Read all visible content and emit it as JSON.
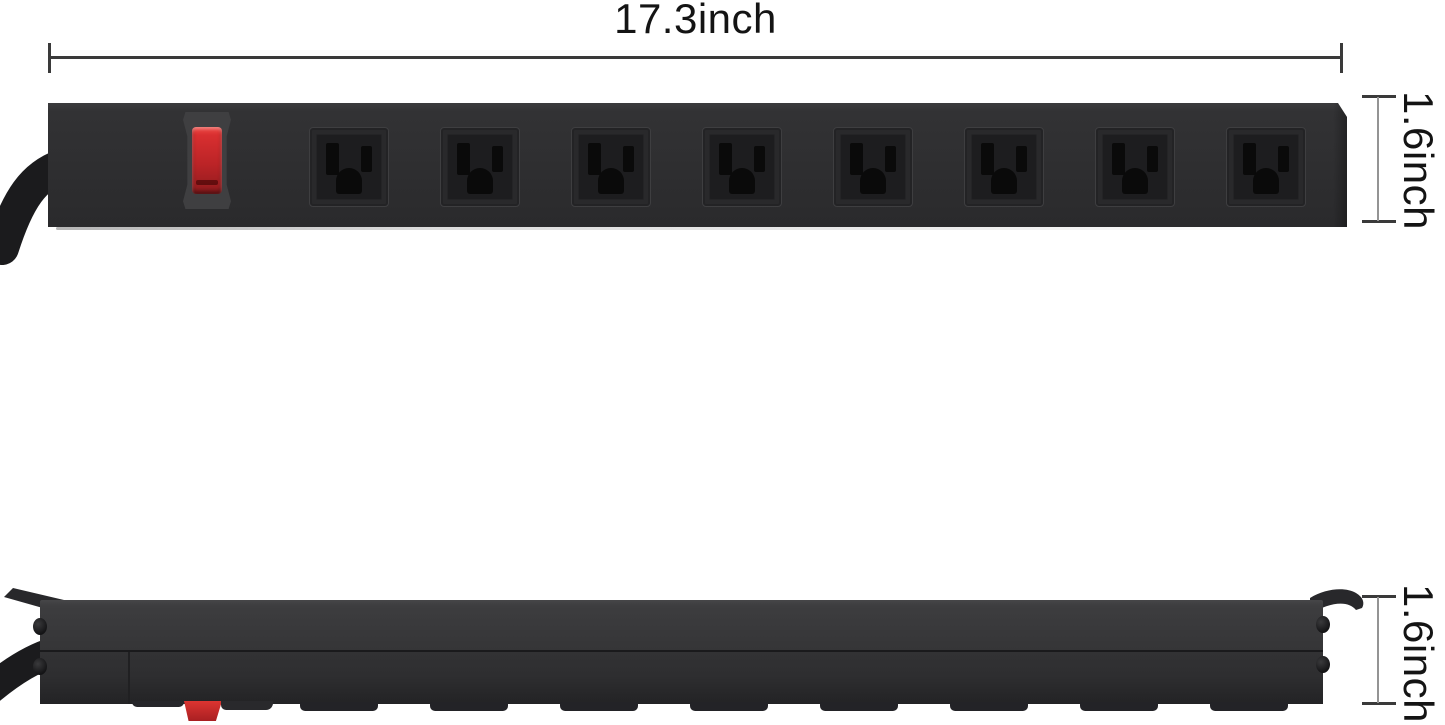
{
  "background": "#ffffff",
  "annotations": {
    "width": "17.3inch",
    "height_front": "1.6inch",
    "height_side": "1.6inch"
  },
  "colors": {
    "strip_body": "#2e2e30",
    "side_top": "#353537",
    "outlet_face": "#29292b",
    "outlet_recess": "#1d1d1f",
    "slot": "#0a0a0a",
    "bezel": "#3f3f41",
    "switch_red": "#bc2427",
    "cord": "#1b1b1d",
    "dim_line": "#949494",
    "dim_dark": "#3a3a3a",
    "dim_text": "#141414"
  },
  "front_view": {
    "description": "black metal power strip, front face",
    "switch": "red-power-switch",
    "outlets": [
      {
        "name": "outlet-1"
      },
      {
        "name": "outlet-2"
      },
      {
        "name": "outlet-3"
      },
      {
        "name": "outlet-4"
      },
      {
        "name": "outlet-5"
      },
      {
        "name": "outlet-6"
      },
      {
        "name": "outlet-7"
      },
      {
        "name": "outlet-8"
      }
    ]
  },
  "side_view": {
    "description": "power strip profile with mounting brackets",
    "parts": [
      "mounting-bracket-left",
      "mounting-bracket-right",
      "power-cord",
      "switch-profile",
      "outlet-feet",
      "screw-heads"
    ]
  }
}
